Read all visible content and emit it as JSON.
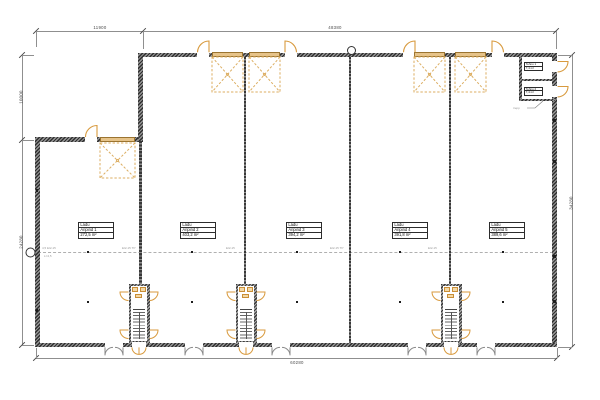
{
  "title": "Ladu floor plan",
  "dimensions": {
    "top_left": "11900",
    "top_right": "48380",
    "left_upper": "10000",
    "left_lower": "24280",
    "right_side": "34280",
    "bottom": "60280"
  },
  "units": [
    {
      "type": "Ladu",
      "name": "Äripind 1",
      "area": "272,5 m²"
    },
    {
      "type": "Ladu",
      "name": "Äripind 2",
      "area": "403,2 m²"
    },
    {
      "type": "Ladu",
      "name": "Äripind 3",
      "area": "394,2 m²"
    },
    {
      "type": "Ladu",
      "name": "Äripind 4",
      "area": "391,8 m²"
    },
    {
      "type": "Ladu",
      "name": "Äripind 5",
      "area": "389,6 m²"
    }
  ],
  "small_rooms": [
    {
      "name": "Tehno 1",
      "area": "7,4 m²"
    },
    {
      "name": "Tehno 2",
      "area": "7,4 m²"
    }
  ],
  "annotations": {
    "leader": "trepp",
    "fire_notes": [
      "4,5 EI2-15",
      "EI2-15 TP",
      "EI2-15",
      "EI2-15 TP",
      "EI2-15",
      "L=4,5"
    ]
  },
  "colors": {
    "wall": "#3a3a3a",
    "door_accent": "#d89a3e",
    "overhead_door": "#dcae62",
    "dim_line": "#8f8f8f",
    "background": "#ffffff"
  }
}
